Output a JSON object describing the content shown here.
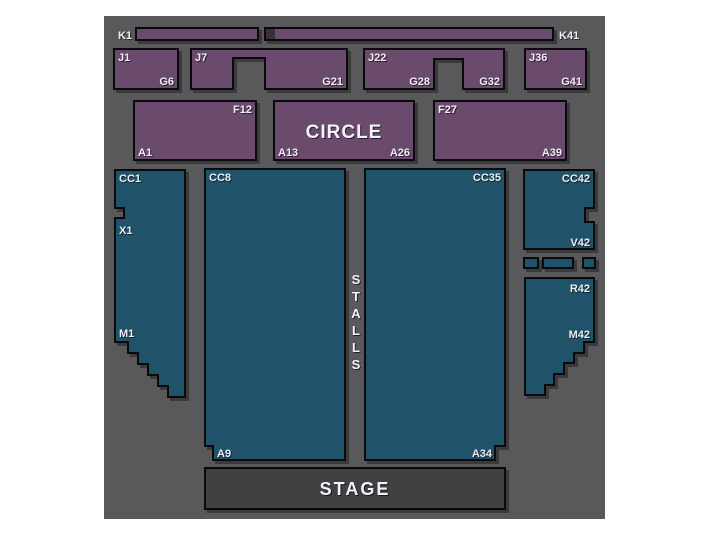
{
  "colors": {
    "page_bg": "#FFFFFF",
    "map_bg": "#59595B",
    "circle_fill": "#6A4B6E",
    "stalls_fill": "#20536A",
    "stage_fill": "#414143",
    "outline": "#0A0A0C",
    "label_text": "#EFEDF2",
    "strip_gap": "#38313C"
  },
  "circle": {
    "row_k": {
      "left_label": "K1",
      "right_label": "K41"
    },
    "row_j": {
      "block1": {
        "row_start": "J1",
        "row_end": "G6"
      },
      "block2": {
        "row_start": "J7",
        "row_end": "G21"
      },
      "block3": {
        "row_start": "J22",
        "mid_end": "G28",
        "row_end": "G32"
      },
      "block4": {
        "row_start": "J36",
        "row_end": "G41"
      }
    },
    "row_f": {
      "block1": {
        "top_right": "F12",
        "bottom_left": "A1"
      },
      "block2": {
        "title": "CIRCLE",
        "bottom_left": "A13",
        "bottom_right": "A26"
      },
      "block3": {
        "top_left": "F27",
        "bottom_right": "A39"
      }
    }
  },
  "stalls": {
    "title": "STALLS",
    "left_block": {
      "top": "CC1",
      "upper": "X1",
      "lower": "M1"
    },
    "center_left_block": {
      "top": "CC8",
      "bottom": "A9"
    },
    "center_right_block": {
      "top": "CC35",
      "bottom": "A34"
    },
    "right_upper_block": {
      "top": "CC42",
      "bottom": "V42"
    },
    "right_lower_block": {
      "top": "R42",
      "lower": "M42"
    }
  },
  "stage": {
    "label": "STAGE"
  }
}
